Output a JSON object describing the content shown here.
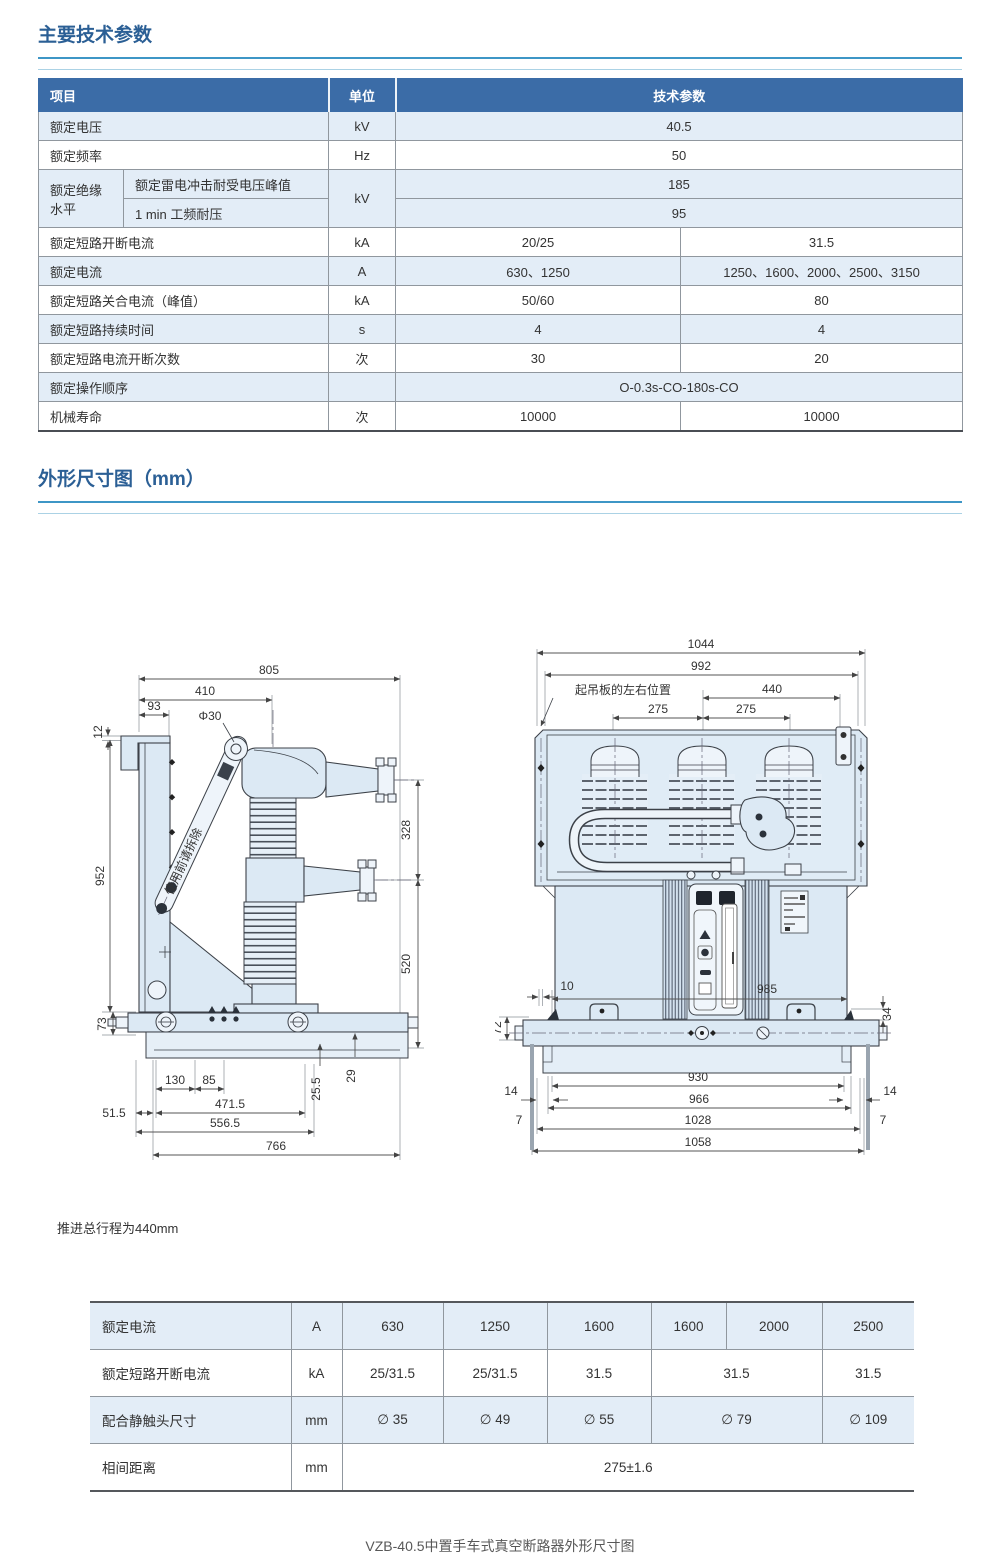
{
  "colors": {
    "accent_blue": "#2b5f95",
    "header_bg": "#3b6ca7",
    "row_alt": "#e3edf7",
    "rule_blue": "#3e96c6",
    "drawing_fill": "#dce9f4"
  },
  "section1": {
    "title": "主要技术参数"
  },
  "params_table": {
    "headers": {
      "item": "项目",
      "unit": "单位",
      "value": "技术参数"
    },
    "rows": {
      "voltage": {
        "label": "额定电压",
        "unit": "kV",
        "value": "40.5"
      },
      "frequency": {
        "label": "额定频率",
        "unit": "Hz",
        "value": "50"
      },
      "insulation": {
        "label": "额定绝缘水平",
        "sub1": "额定雷电冲击耐受电压峰值",
        "sub2": "1 min 工频耐压",
        "unit": "kV",
        "value1": "185",
        "value2": "95"
      },
      "breaking_current": {
        "label": "额定短路开断电流",
        "unit": "kA",
        "left": "20/25",
        "right": "31.5"
      },
      "rated_current": {
        "label": "额定电流",
        "unit": "A",
        "left": "630、1250",
        "right": "1250、1600、2000、2500、3150"
      },
      "making_current": {
        "label": "额定短路关合电流（峰值）",
        "unit": "kA",
        "left": "50/60",
        "right": "80"
      },
      "duration": {
        "label": "额定短路持续时间",
        "unit": "s",
        "left": "4",
        "right": "4"
      },
      "breaking_times": {
        "label": "额定短路电流开断次数",
        "unit": "次",
        "left": "30",
        "right": "20"
      },
      "sequence": {
        "label": "额定操作顺序",
        "unit": "",
        "value": "O-0.3s-CO-180s-CO"
      },
      "mech_life": {
        "label": "机械寿命",
        "unit": "次",
        "left": "10000",
        "right": "10000"
      }
    }
  },
  "section2": {
    "title": "外形尺寸图（mm）"
  },
  "side_view": {
    "arm_note": "使用前请拆除",
    "dims": {
      "d805": "805",
      "d410": "410",
      "d93": "93",
      "d12": "12",
      "phi30": "Φ30",
      "d952": "952",
      "d328": "328",
      "d520": "520",
      "d73": "73",
      "d130": "130",
      "d85": "85",
      "d25_5": "25.5",
      "d29": "29",
      "d51_5": "51.5",
      "d471_5": "471.5",
      "d556_5": "556.5",
      "d766": "766"
    }
  },
  "front_view": {
    "labels": {
      "lifting_plate": "起吊板的左右位置"
    },
    "dims": {
      "d1044": "1044",
      "d992": "992",
      "d440": "440",
      "d275L": "275",
      "d275R": "275",
      "d10": "10",
      "d985": "985",
      "d34": "34",
      "d72": "72",
      "d930": "930",
      "d14L": "14",
      "d14R": "14",
      "d966": "966",
      "d7L": "7",
      "d7R": "7",
      "d1028": "1028",
      "d1058": "1058"
    }
  },
  "note": "推进总行程为440mm",
  "selection_table": {
    "rows": {
      "current": {
        "label": "额定电流",
        "unit": "A",
        "v1": "630",
        "v2": "1250",
        "v3": "1600",
        "v4": "1600",
        "v5": "2000",
        "v6": "2500"
      },
      "breaking": {
        "label": "额定短路开断电流",
        "unit": "kA",
        "v1": "25/31.5",
        "v2": "25/31.5",
        "v3": "31.5",
        "v45": "31.5",
        "v6": "31.5"
      },
      "contact": {
        "label": "配合静触头尺寸",
        "unit": "mm",
        "v1": "∅ 35",
        "v2": "∅ 49",
        "v3": "∅ 55",
        "v45": "∅ 79",
        "v6": "∅ 109"
      },
      "spacing": {
        "label": "相间距离",
        "unit": "mm",
        "value": "275±1.6"
      }
    }
  },
  "caption": "VZB-40.5中置手车式真空断路器外形尺寸图"
}
